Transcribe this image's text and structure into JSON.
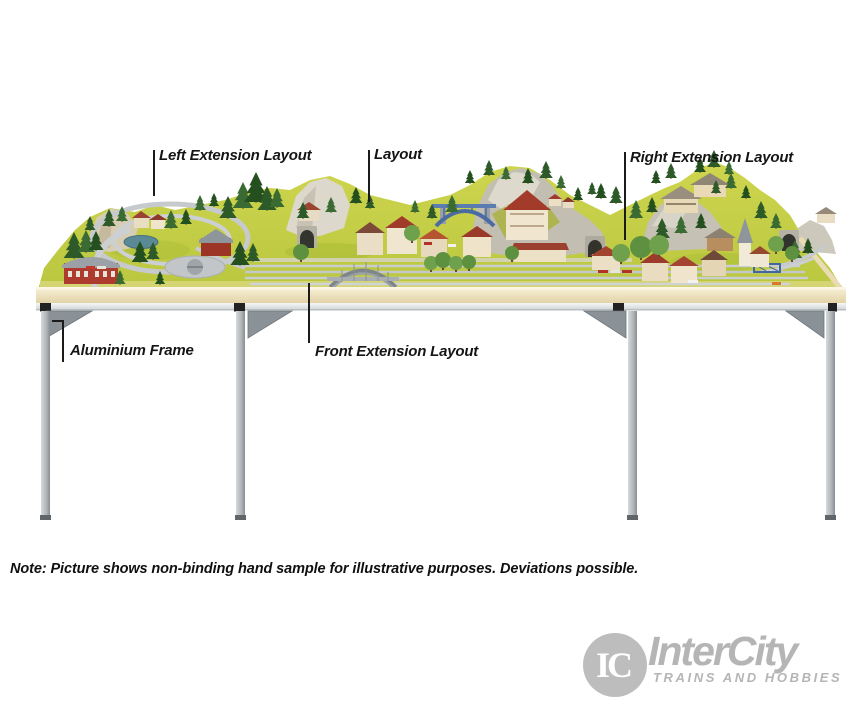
{
  "annotations": {
    "left_extension": "Left Extension Layout",
    "layout": "Layout",
    "right_extension": "Right Extension Layout",
    "aluminium_frame": "Aluminium Frame",
    "front_extension": "Front Extension Layout"
  },
  "note": "Note: Picture shows non-binding hand sample for illustrative purposes. Deviations possible.",
  "logo": {
    "monogram": "IC",
    "name": "InterCity",
    "tagline": "TRAINS AND HOBBIES",
    "color": "#b5b5b5"
  },
  "scene": {
    "subject": "model-railway-layout-on-aluminium-frame-table",
    "colors": {
      "grass": "#c6ce44",
      "wood_edge": "#eee3c0",
      "frame_aluminium": "#b4b9bc",
      "gusset": "#8a9298",
      "rock": "#c2beb1",
      "pond": "#5b8a96",
      "bridge_blue": "#4a6ca3",
      "roof_red": "#a03a2c",
      "tree_green": "#2d5a28"
    }
  }
}
